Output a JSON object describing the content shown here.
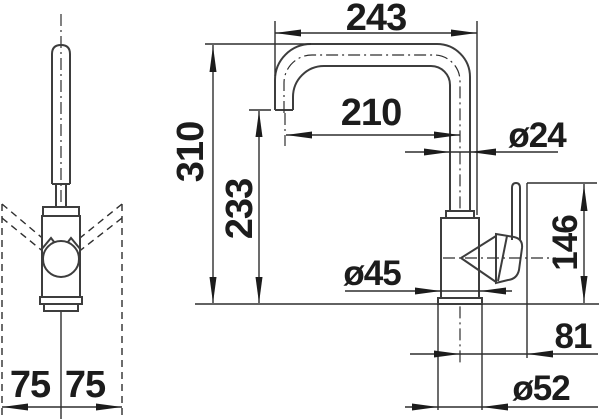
{
  "drawing": {
    "kind": "faucet-dimension-drawing",
    "units": "mm",
    "colors": {
      "line": "#3d3d3d",
      "text": "#1c1c1c",
      "background": "#ffffff"
    },
    "views": {
      "front": {
        "clearance_left": "75",
        "clearance_right": "75"
      },
      "side": {
        "reach_overall": "243",
        "reach_to_axis": "210",
        "spout_diameter": "ø24",
        "total_height": "310",
        "outlet_height": "233",
        "lever_height": "146",
        "body_diameter": "ø45",
        "lever_offset": "81",
        "base_diameter": "ø52"
      }
    }
  }
}
